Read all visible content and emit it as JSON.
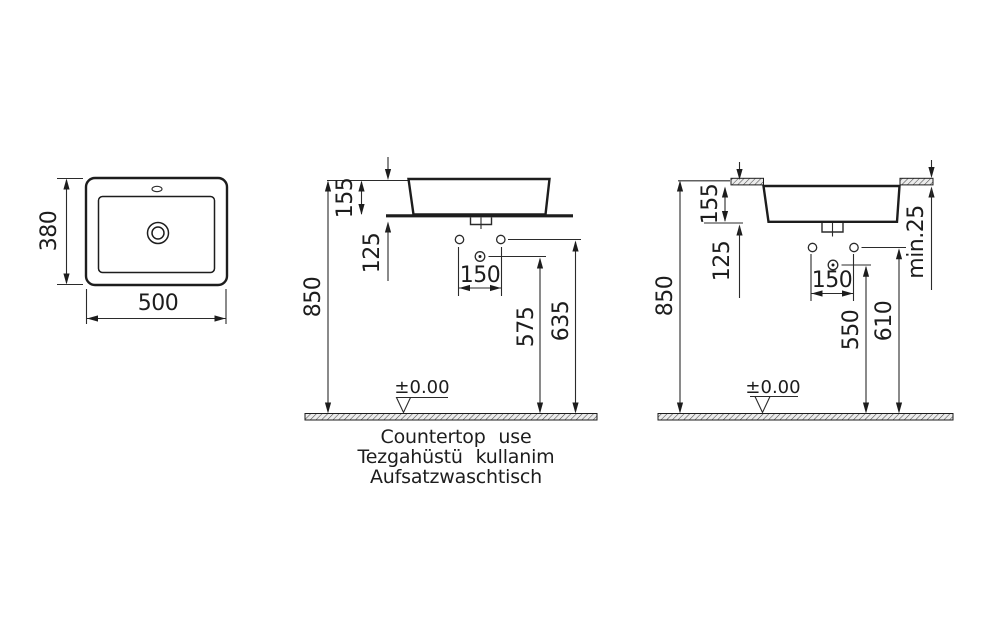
{
  "views": {
    "top": {
      "width": "500",
      "depth": "380"
    },
    "countertop": {
      "basin_height": "155",
      "hole_drop": "125",
      "hole_spacing": "150",
      "overall_height": "850",
      "drain_height": "575",
      "supply_height": "635",
      "floor_level": "±0.00"
    },
    "recessed": {
      "basin_height": "155",
      "hole_drop": "125",
      "hole_spacing": "150",
      "overall_height": "850",
      "drain_height": "550",
      "supply_height": "610",
      "counter_min_thickness": "min.25",
      "floor_level": "±0.00"
    }
  },
  "caption": {
    "en": "Countertop use",
    "tr": "Tezgahüstü kullanim",
    "de": "Aufsatzwaschtisch"
  },
  "colors": {
    "line": "#1d1d1d",
    "background": "#ffffff"
  }
}
